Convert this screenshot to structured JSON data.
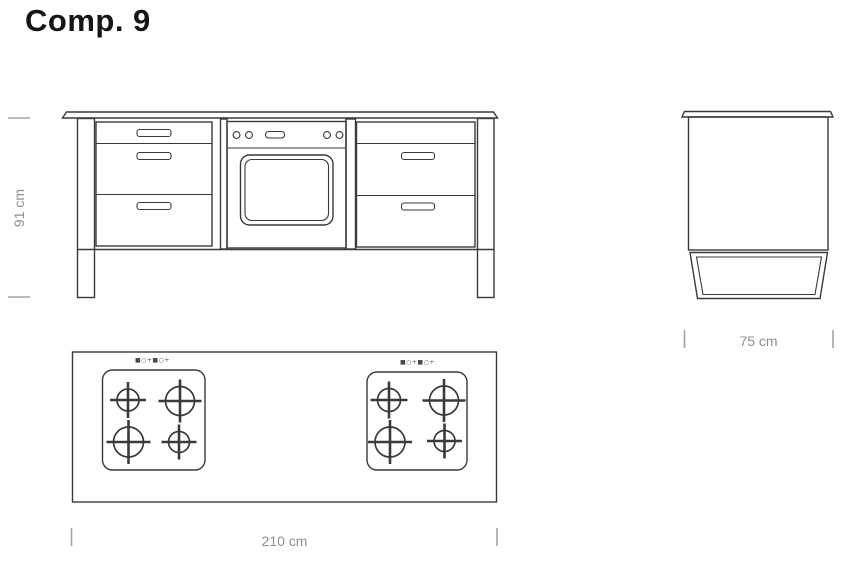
{
  "title": "Comp. 9",
  "dimensions": {
    "height": "91 cm",
    "width": "210 cm",
    "depth": "75 cm"
  },
  "top_view": {
    "hob1_marks": "■○+■○+",
    "hob2_marks": "■○+■○+"
  },
  "colors": {
    "line": "#3a3a3a",
    "dimension_gray": "#8f8f8f",
    "title_text": "#151515",
    "background": "#ffffff"
  }
}
